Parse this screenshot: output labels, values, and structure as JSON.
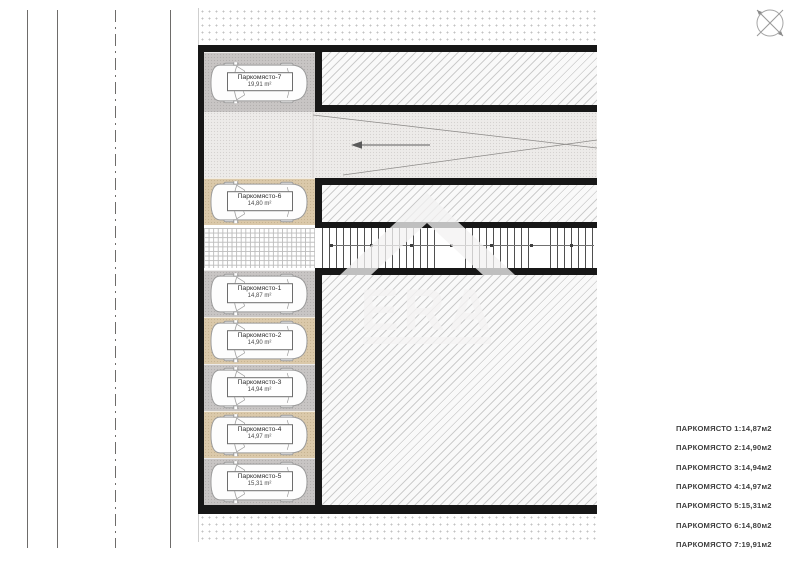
{
  "plan": {
    "slots": [
      {
        "id": "7",
        "label": "Паркомясто-7",
        "area": "19,91 m²"
      },
      {
        "id": "6",
        "label": "Паркомясто-6",
        "area": "14,80 m²"
      },
      {
        "id": "1",
        "label": "Паркомясто-1",
        "area": "14,87 m²"
      },
      {
        "id": "2",
        "label": "Паркомясто-2",
        "area": "14,90 m²"
      },
      {
        "id": "3",
        "label": "Паркомясто-3",
        "area": "14,94 m²"
      },
      {
        "id": "4",
        "label": "Паркомясто-4",
        "area": "14,97 m²"
      },
      {
        "id": "5",
        "label": "Паркомясто-5",
        "area": "15,31 m²"
      }
    ]
  },
  "legend": {
    "rows": [
      {
        "label": "ПАРКОМЯСТО 1:",
        "value": "14,87м2"
      },
      {
        "label": "ПАРКОМЯСТО 2:",
        "value": "14,90м2"
      },
      {
        "label": "ПАРКОМЯСТО 3:",
        "value": "14,94м2"
      },
      {
        "label": "ПАРКОМЯСТО 4:",
        "value": "14,97м2"
      },
      {
        "label": "ПАРКОМЯСТО 5:",
        "value": "15,31м2"
      },
      {
        "label": "ПАРКОМЯСТО 6:",
        "value": "14,80м2"
      },
      {
        "label": "ПАРКОМЯСТО 7:",
        "value": "19,91м2"
      }
    ]
  },
  "watermark": {
    "text": "ERA"
  },
  "icons": {
    "compass": "north-arrow-icon",
    "driveway_arrow": "arrow-left-icon",
    "car": "car-top-view-icon"
  },
  "colors": {
    "wall": "#171717",
    "slot_gray": "#c8c5c4",
    "slot_tan": "#dbc9aa",
    "driveway": "#edebe9",
    "hatch_line": "#a0a0a0"
  }
}
